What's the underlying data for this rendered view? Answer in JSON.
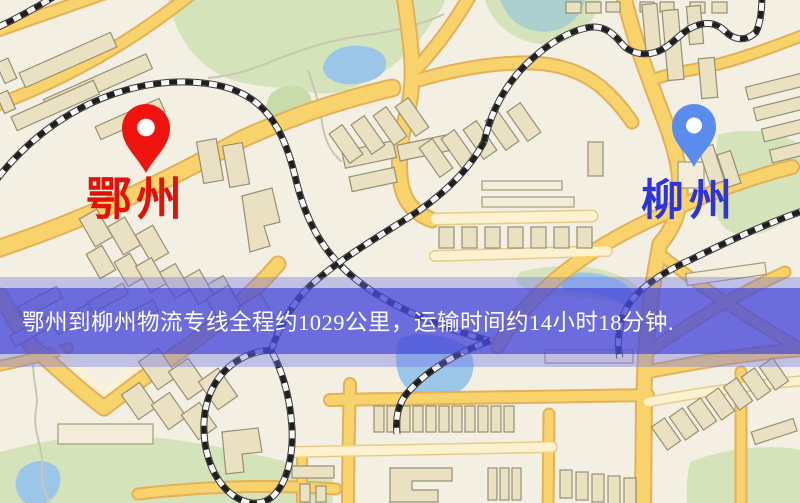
{
  "banner": {
    "text": "鄂州到柳州物流专线全程约1029公里，运输时间约14小时18分钟.",
    "distance_km": "1029",
    "duration_hours": "14",
    "duration_minutes": "18",
    "text_color": "#ffffff",
    "band_color": "rgba(64,66,215,0.66)",
    "halo_color": "rgba(110,114,232,0.38)"
  },
  "markers": {
    "origin": {
      "label": "鄂州",
      "pin_color": "#f01410",
      "label_color": "#e31208"
    },
    "destination": {
      "label": "柳州",
      "pin_color": "#5a8cee",
      "label_color": "#2e35d8"
    }
  },
  "map_palette": {
    "background": "#f3efe3",
    "road_major": "#f8d26b",
    "road_minor": "#fdf2cf",
    "park": "#d5e3ba",
    "water": "#9cc6e8",
    "railway": "#1f1f1f",
    "building": "#eae0c2"
  }
}
